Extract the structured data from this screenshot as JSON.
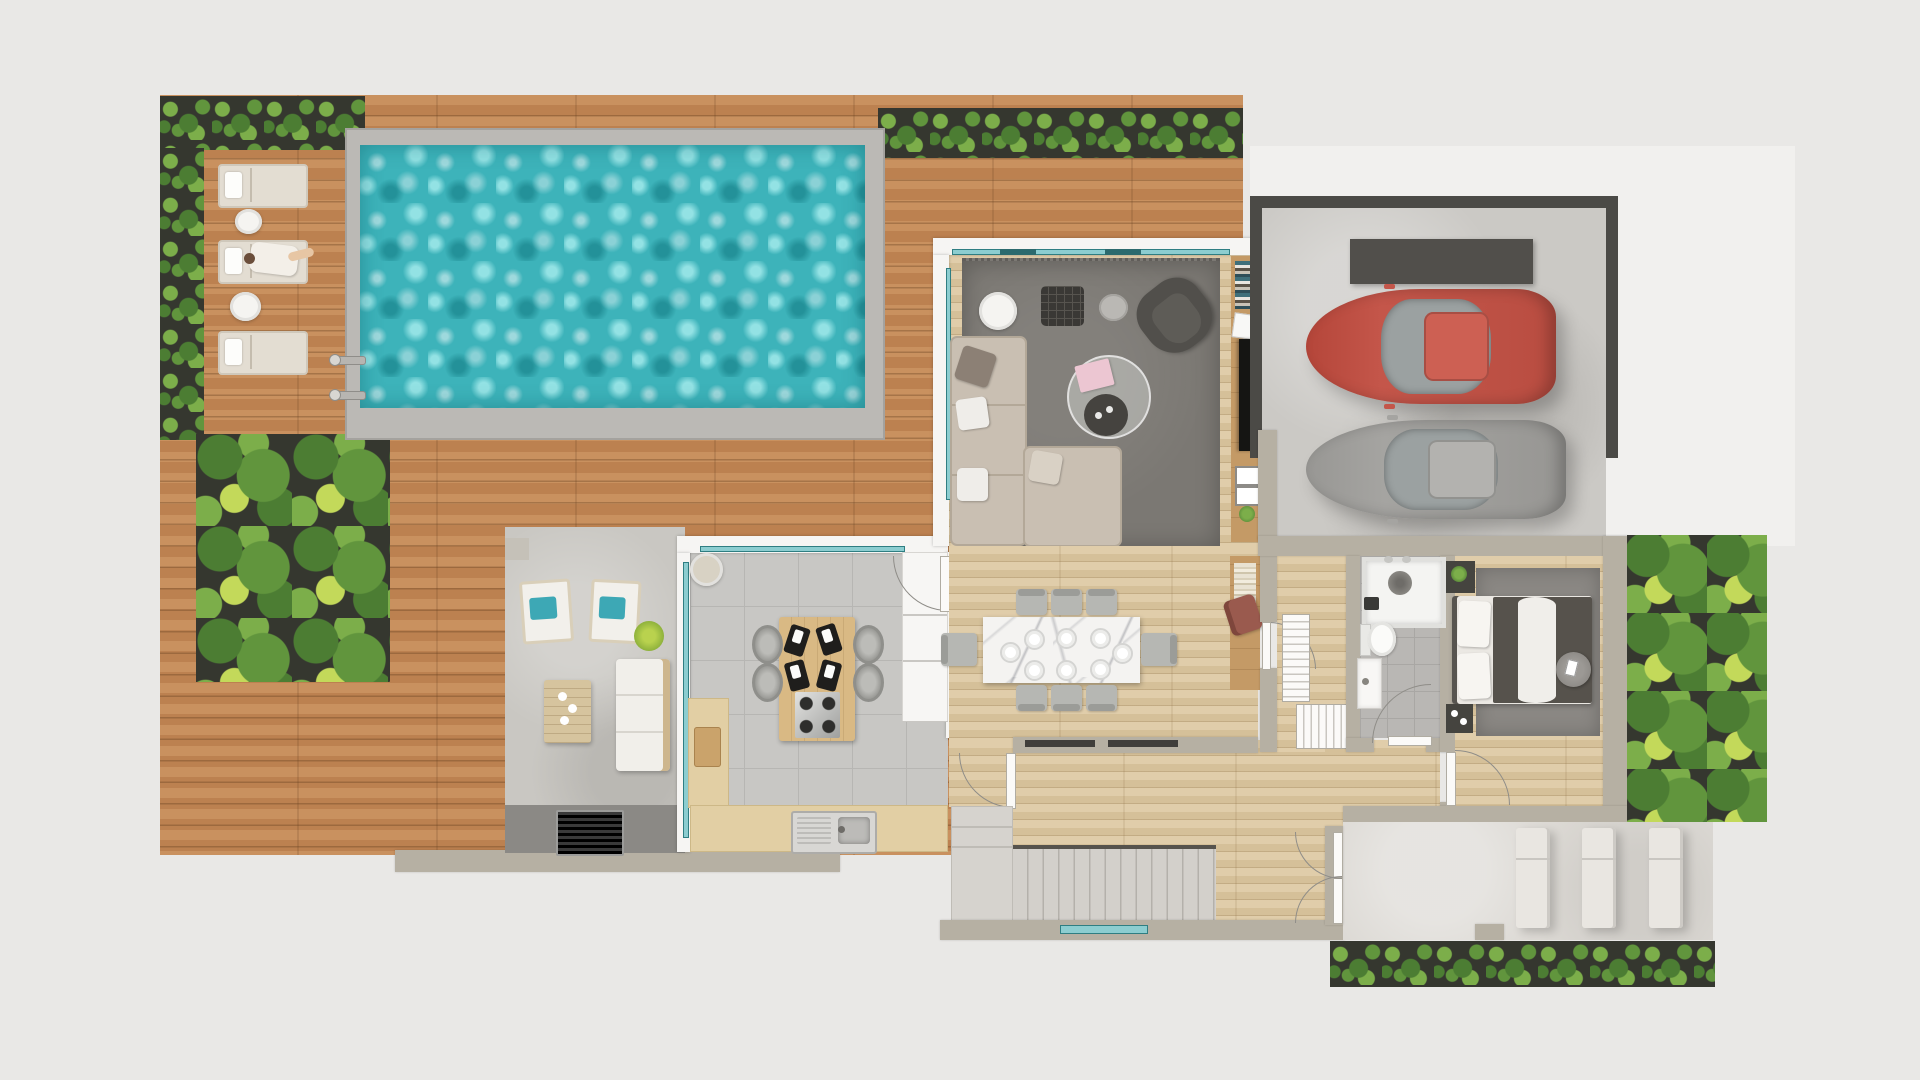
{
  "scene": {
    "title": "villa-first-floor-plan-top-down-3d-render",
    "type": "architectural floor plan",
    "view": "top-down",
    "visible_text": "none"
  },
  "palette": {
    "bg": "#e9e8e6",
    "wood": "#c08655",
    "floor": "#d9c5a0",
    "tile": "#c8c7c4",
    "conc": "#cbc9c5",
    "patio": "#c9c7c2",
    "terr": "#dcd9d4",
    "stair": "#d3d0cb",
    "wall_white": "#f6f5f3",
    "wall_beige": "#b6b0a3",
    "planter": "#35372f",
    "leaf1": "#4c7d33",
    "leaf2": "#61953d",
    "leaf3": "#7cae4a",
    "leaf4": "#c3d95a",
    "water": "#3db3ba",
    "water_hi": "#93e2e4",
    "pool_edge": "#bbb9b5",
    "teal": "#2f7e82",
    "glass_teal": "#8ccdd0",
    "rug": "#7b7873",
    "sofa": "#c9bfb2",
    "marble": "#f4f3f1",
    "car_red": "#c4564a",
    "car_gray": "#a5a4a1",
    "rust": "#9a5a4e",
    "cushion_teal": "#3da8b5"
  },
  "outdoor": {
    "pool": {
      "shape": "rectangle",
      "loungers": 3,
      "occupied_loungers": 1,
      "side_tables": 2,
      "ladder_rails": 2
    },
    "deck": {
      "material": "wood planks"
    },
    "patio_lounge": {
      "deck_chairs": 2,
      "deck_chair_cushion": "teal",
      "sofa_seats": 3,
      "coffee_table_cups": 3,
      "bbq_grill": 1,
      "shrub": 1
    },
    "terrace": {
      "loungers": 3
    },
    "gardens": {
      "hedge_strips": 3,
      "palm_garden": 1,
      "side_garden": 1,
      "rear_hedge": 1
    }
  },
  "rooms": {
    "living_room": {
      "sofa": "L-shaped beige",
      "armchair": 1,
      "ottoman": 1,
      "side_tables": 2,
      "coffee_table": "round glass",
      "tv": 1,
      "bookshelf": 1,
      "rug": "gray"
    },
    "kitchen": {
      "island_seats": 4,
      "island_place_settings": 4,
      "cooktop_burners": 4,
      "sink": 1,
      "breakfast_table": 1,
      "tall_cabinets": 1,
      "cutting_board": 1
    },
    "dining_room": {
      "chairs": 8,
      "place_settings": 8,
      "table_top": "white marble"
    },
    "bathroom": {
      "shower": 1,
      "toilet": 1,
      "vanity": 1
    },
    "bedroom": {
      "bed": "double",
      "nightstands": 2,
      "pouf": 1,
      "rug": "gray"
    },
    "garage": {
      "cars": [
        {
          "color": "red"
        },
        {
          "color": "gray"
        }
      ],
      "storage_cabinet": 1
    },
    "hallway": {
      "desk": 1,
      "desk_chair": "rust",
      "closets": 2,
      "french_doors": 1
    },
    "stairs": {
      "treads": 13,
      "landing": true
    }
  }
}
